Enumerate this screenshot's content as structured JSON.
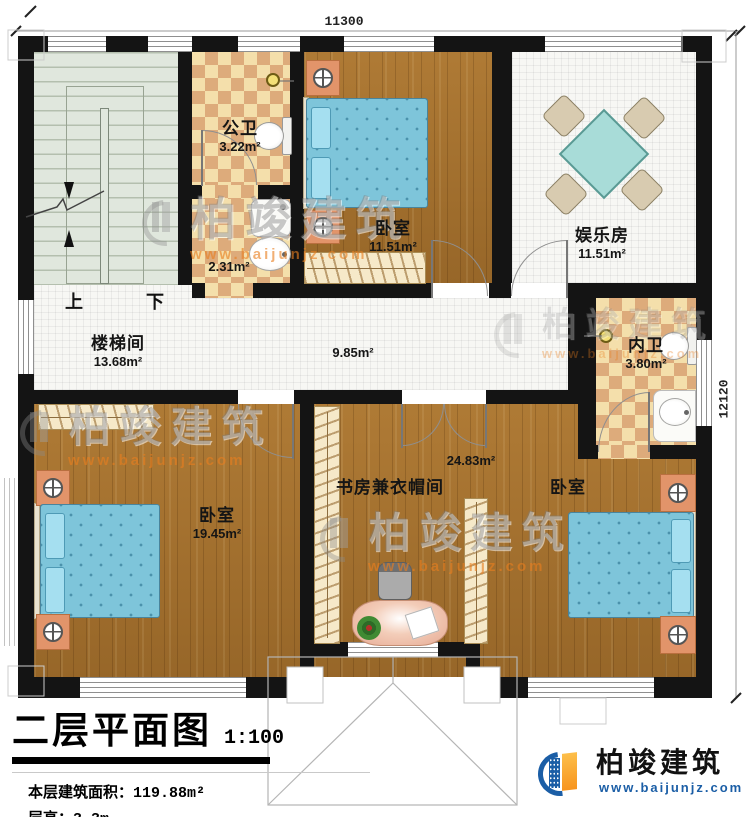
{
  "plan": {
    "dimension_width": "11300",
    "dimension_height": "12120",
    "stairs": {
      "up": "上",
      "down": "下"
    },
    "rooms": [
      {
        "name": "公卫",
        "area": "3.22m²"
      },
      {
        "name": "",
        "area": "2.31m²"
      },
      {
        "name": "卧室",
        "area": "11.51m²"
      },
      {
        "name": "娱乐房",
        "area": "11.51m²"
      },
      {
        "name": "楼梯间",
        "area": "13.68m²"
      },
      {
        "name": "",
        "area": "9.85m²"
      },
      {
        "name": "内卫",
        "area": "3.80m²"
      },
      {
        "name": "卧室",
        "area": "19.45m²"
      },
      {
        "name": "书房兼衣帽间",
        "area": "24.83m²"
      },
      {
        "name": "卧室",
        "area": ""
      }
    ]
  },
  "title_block": {
    "title": "二层平面图",
    "scale": "1:100",
    "area_label": "本层建筑面积：",
    "area_value": "119.88m²",
    "height_label": "层高：",
    "height_value": "3.3m"
  },
  "branding": {
    "company": "柏竣建筑",
    "website": "www.baijunjz.com"
  },
  "watermark": {
    "company": "柏竣建筑",
    "website": "www.baijunjz.com"
  },
  "colors": {
    "wood": "#a8722d",
    "tile": "#f7f7f4",
    "checker_light": "#f4dfab",
    "checker_dark": "#ddab7b",
    "stair": "#e0e7dd",
    "wall": "#141414",
    "mattress": "#7ec5da",
    "pillow": "#a5dff0",
    "furniture_orange": "#e2946a",
    "wardrobe": "#f6e9c9",
    "table_teal": "#a8dcd8",
    "desk_pink": "#e7ab95",
    "brand_blue": "#1b5ea6",
    "brand_orange": "#f7941d"
  }
}
